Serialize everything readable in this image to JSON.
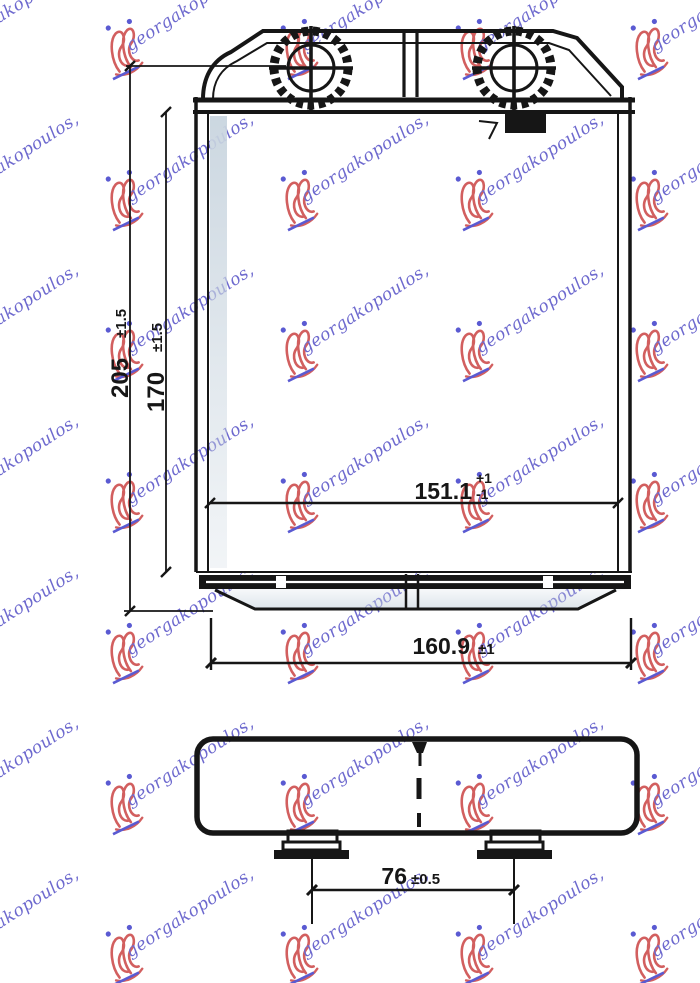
{
  "watermark": {
    "text": "georgakopoulos,",
    "text_color": "#5a55c8",
    "logo_color": "#cc4a4a",
    "accent_color": "#4444cc"
  },
  "drawing": {
    "ink_color": "#161616",
    "shade_color": "#c9d5df",
    "dims": {
      "total_height": {
        "value": "205",
        "tol": "±1.5"
      },
      "core_height": {
        "value": "170",
        "tol": "±1.5"
      },
      "core_width": {
        "value": "151.1",
        "tol_plus": "+1",
        "tol_minus": "-1"
      },
      "total_width": {
        "value": "160.9",
        "tol": "±1"
      },
      "foot_spacing": {
        "value": "76",
        "tol": "±0.5"
      }
    }
  }
}
